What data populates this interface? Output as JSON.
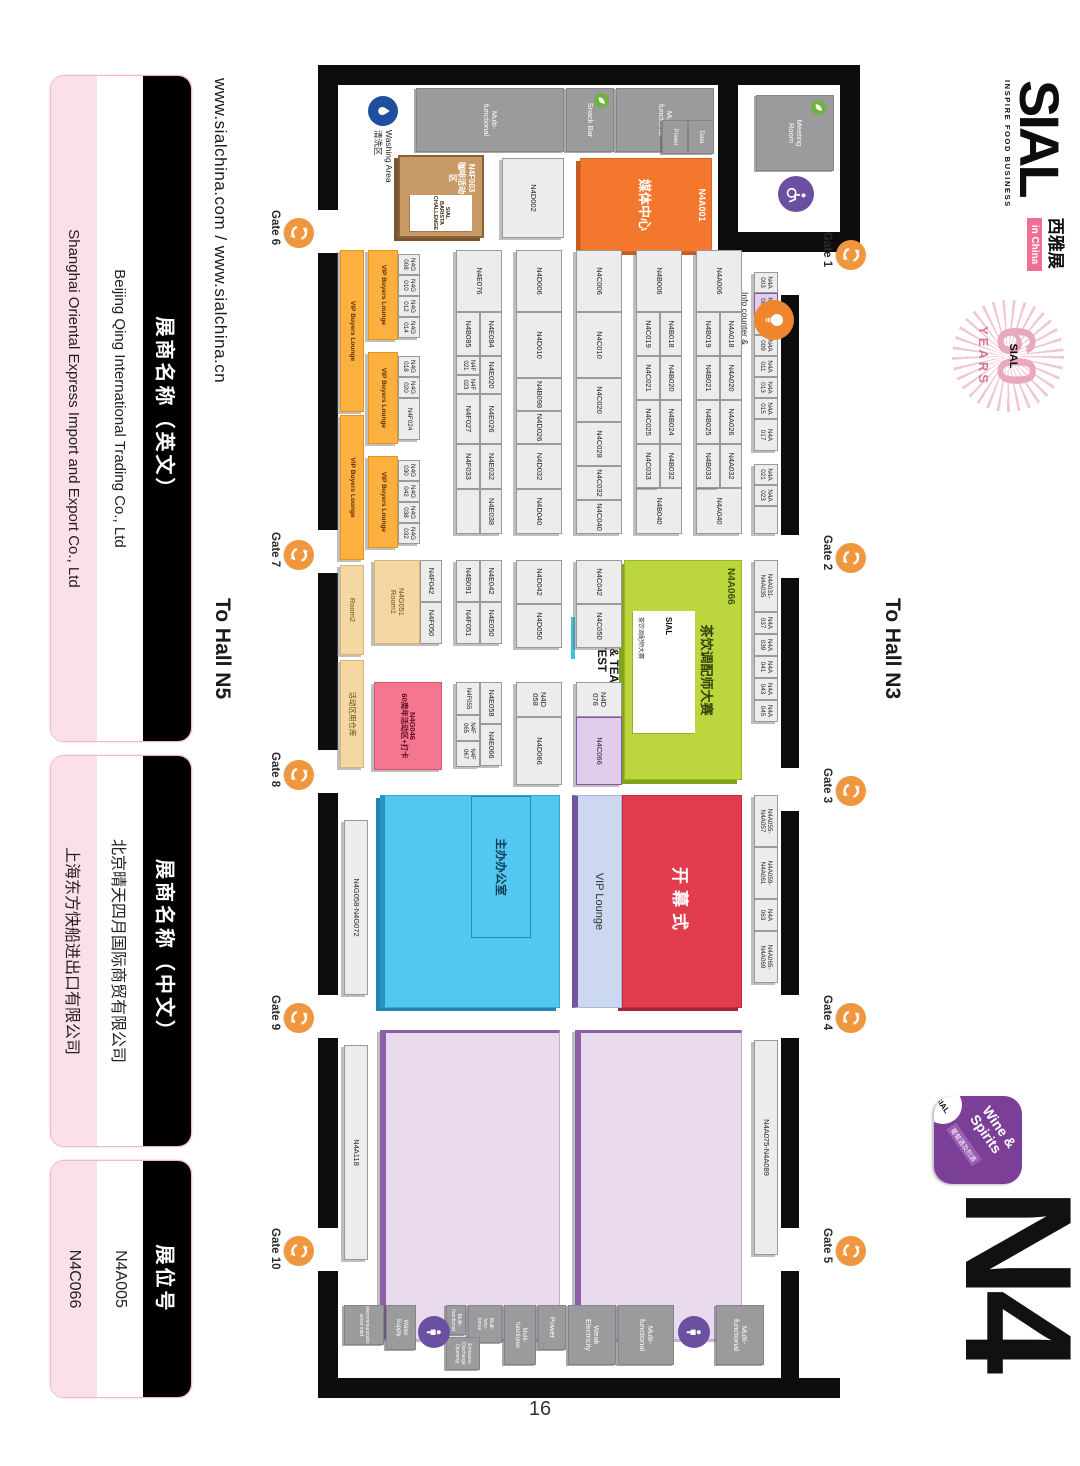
{
  "page": {
    "number": "16"
  },
  "branding": {
    "sial": "SIAL",
    "tagline": "INSPIRE FOOD BUSINESS",
    "cn_name": "西雅展",
    "in_china": "in China",
    "years_60": "60",
    "years_label": "YEARS",
    "years_sial": "SIAL",
    "hall_code": "N4",
    "wine_line": "Wine &\nSpirits",
    "wine_cn": "葡萄酒及烈酒",
    "wine_sial": "SIAL"
  },
  "links": {
    "urls": "www.sialchina.com / www.sialchina.cn"
  },
  "nav": {
    "to_n3": "To Hall N3",
    "to_n5": "To Hall N5"
  },
  "legend_cards": [
    {
      "header": "展商名称（英文）",
      "row1": "Beijing Qing International Trading Co., Ltd",
      "row2": "Shanghai Oriental Express Import and Export Co., Ltd"
    },
    {
      "header": "展商名称（中文）",
      "row1": "北京晴天四月国际商贸有限公司",
      "row2": "上海东方快船进出口有限公司"
    },
    {
      "header": "展位号",
      "row1": "N4A005",
      "row2": "N4C066"
    }
  ],
  "map": {
    "meeting_room": "Meeting\nRoom",
    "info_counter": "Info counter &\ncatalogue selling\n问讯处 & 会刊销售处",
    "washing": "Washing Area\n清洗区",
    "media_id": "N4A001",
    "media_label": "媒体中心",
    "coffee_id": "N4F003",
    "coffee_label": "咖啡活动区",
    "coffee_chip": "SIAL\nBARISTA\nCHALLENGE",
    "contest_id": "N4A066",
    "contest_label": "茶饮调配师大赛",
    "contest_chip_brand": "SIAL",
    "contest_chip_sub": "茶饮调配师大赛",
    "contest_chip_main": "CHIC & TEA\nCONTEST",
    "opening": "开幕式",
    "vip_lounge": "VIP Lounge",
    "office": "主办办公室"
  },
  "gates": [
    {
      "label": "Gate 1",
      "x": 240,
      "y": 214,
      "side": "top"
    },
    {
      "label": "Gate 2",
      "x": 543,
      "y": 214,
      "side": "top"
    },
    {
      "label": "Gate 3",
      "x": 776,
      "y": 214,
      "side": "top"
    },
    {
      "label": "Gate 4",
      "x": 1003,
      "y": 214,
      "side": "top"
    },
    {
      "label": "Gate 5",
      "x": 1236,
      "y": 214,
      "side": "top"
    },
    {
      "label": "Gate 6",
      "x": 218,
      "y": 766,
      "side": "bottom"
    },
    {
      "label": "Gate 7",
      "x": 540,
      "y": 766,
      "side": "bottom"
    },
    {
      "label": "Gate 8",
      "x": 760,
      "y": 766,
      "side": "bottom"
    },
    {
      "label": "Gate 9",
      "x": 1003,
      "y": 766,
      "side": "bottom"
    },
    {
      "label": "Gate 10",
      "x": 1236,
      "y": 766,
      "side": "bottom"
    }
  ],
  "icons": [
    {
      "glyph": "wheelchair",
      "name": "wheelchair-icon",
      "x": 176,
      "y": 266,
      "d": 36,
      "bg": "#6b4fa1"
    },
    {
      "glyph": "drop",
      "name": "washing-area-icon",
      "x": 96,
      "y": 682,
      "d": 30,
      "bg": "#1d4f9e"
    },
    {
      "glyph": "bulb",
      "name": "info-counter-icon",
      "x": 300,
      "y": 286,
      "d": 40,
      "bg": "#f0862c"
    },
    {
      "glyph": "leaf",
      "name": "meeting-room-eco-icon",
      "x": 100,
      "y": 254,
      "d": 15,
      "bg": "#6db33f"
    },
    {
      "glyph": "leaf",
      "name": "snack-bar-eco-icon",
      "x": 93,
      "y": 471,
      "d": 15,
      "bg": "#6db33f"
    },
    {
      "glyph": "person",
      "name": "restroom-icon-1",
      "x": 1316,
      "y": 370,
      "d": 32,
      "bg": "#6b4fa1"
    },
    {
      "glyph": "person",
      "name": "restroom-icon-2",
      "x": 1316,
      "y": 630,
      "d": 32,
      "bg": "#6b4fa1"
    }
  ],
  "booths": [
    {
      "t": "N4A\n003",
      "x": 272,
      "y": 302,
      "w": 21,
      "h": 24,
      "c": "b s2"
    },
    {
      "t": "N4A\n005",
      "x": 293,
      "y": 302,
      "w": 21,
      "h": 24,
      "c": "bp s2"
    },
    {
      "t": "N4A\n007",
      "x": 314,
      "y": 302,
      "w": 21,
      "h": 24,
      "c": "b s2"
    },
    {
      "t": "N4A\n009",
      "x": 335,
      "y": 302,
      "w": 21,
      "h": 24,
      "c": "b s2"
    },
    {
      "t": "N4A\n011",
      "x": 356,
      "y": 302,
      "w": 21,
      "h": 24,
      "c": "b s2"
    },
    {
      "t": "N4A\n013",
      "x": 377,
      "y": 302,
      "w": 21,
      "h": 24,
      "c": "b s2"
    },
    {
      "t": "N4A\n015",
      "x": 398,
      "y": 302,
      "w": 21,
      "h": 24,
      "c": "b s2"
    },
    {
      "t": "N4A\n017",
      "x": 419,
      "y": 302,
      "w": 32,
      "h": 24,
      "c": "b s2"
    },
    {
      "t": "N4A\n021",
      "x": 464,
      "y": 302,
      "w": 21,
      "h": 24,
      "c": "b s2"
    },
    {
      "t": "N4A\n023",
      "x": 485,
      "y": 302,
      "w": 21,
      "h": 24,
      "c": "b s2"
    },
    {
      "t": "",
      "x": 506,
      "y": 302,
      "w": 28,
      "h": 24,
      "c": "b s2"
    },
    {
      "t": "N4A006",
      "x": 250,
      "y": 338,
      "w": 62,
      "h": 46,
      "c": "b"
    },
    {
      "t": "N4A018",
      "x": 312,
      "y": 338,
      "w": 44,
      "h": 22,
      "c": "b"
    },
    {
      "t": "N4A020",
      "x": 356,
      "y": 338,
      "w": 44,
      "h": 22,
      "c": "b"
    },
    {
      "t": "N4A026",
      "x": 400,
      "y": 338,
      "w": 44,
      "h": 22,
      "c": "b"
    },
    {
      "t": "N4A032",
      "x": 444,
      "y": 338,
      "w": 44,
      "h": 22,
      "c": "b"
    },
    {
      "t": "N4A040",
      "x": 488,
      "y": 338,
      "w": 46,
      "h": 46,
      "c": "b"
    },
    {
      "t": "N4B019",
      "x": 312,
      "y": 360,
      "w": 44,
      "h": 24,
      "c": "b"
    },
    {
      "t": "N4B021",
      "x": 356,
      "y": 360,
      "w": 44,
      "h": 24,
      "c": "b"
    },
    {
      "t": "N4B025",
      "x": 400,
      "y": 360,
      "w": 44,
      "h": 24,
      "c": "b"
    },
    {
      "t": "N4B033",
      "x": 444,
      "y": 360,
      "w": 44,
      "h": 24,
      "c": "b"
    },
    {
      "t": "N4B006",
      "x": 250,
      "y": 398,
      "w": 62,
      "h": 46,
      "c": "b"
    },
    {
      "t": "N4B018",
      "x": 312,
      "y": 398,
      "w": 44,
      "h": 22,
      "c": "b"
    },
    {
      "t": "N4B020",
      "x": 356,
      "y": 398,
      "w": 44,
      "h": 22,
      "c": "b"
    },
    {
      "t": "N4B024",
      "x": 400,
      "y": 398,
      "w": 44,
      "h": 22,
      "c": "b"
    },
    {
      "t": "N4B032",
      "x": 444,
      "y": 398,
      "w": 44,
      "h": 22,
      "c": "b"
    },
    {
      "t": "N4B040",
      "x": 488,
      "y": 398,
      "w": 46,
      "h": 46,
      "c": "b"
    },
    {
      "t": "N4C019",
      "x": 312,
      "y": 420,
      "w": 44,
      "h": 24,
      "c": "b"
    },
    {
      "t": "N4C021",
      "x": 356,
      "y": 420,
      "w": 44,
      "h": 24,
      "c": "b"
    },
    {
      "t": "N4C025",
      "x": 400,
      "y": 420,
      "w": 44,
      "h": 24,
      "c": "b"
    },
    {
      "t": "N4C033",
      "x": 444,
      "y": 420,
      "w": 44,
      "h": 24,
      "c": "b"
    },
    {
      "t": "N4C006",
      "x": 250,
      "y": 458,
      "w": 62,
      "h": 46,
      "c": "b"
    },
    {
      "t": "N4C010",
      "x": 312,
      "y": 458,
      "w": 66,
      "h": 46,
      "c": "b"
    },
    {
      "t": "N4C020",
      "x": 378,
      "y": 458,
      "w": 44,
      "h": 46,
      "c": "b"
    },
    {
      "t": "N4C028",
      "x": 422,
      "y": 458,
      "w": 44,
      "h": 46,
      "c": "b"
    },
    {
      "t": "N4C032",
      "x": 466,
      "y": 458,
      "w": 34,
      "h": 46,
      "c": "b"
    },
    {
      "t": "N4C040",
      "x": 500,
      "y": 458,
      "w": 34,
      "h": 46,
      "c": "b"
    },
    {
      "t": "N4D006",
      "x": 250,
      "y": 518,
      "w": 62,
      "h": 46,
      "c": "b"
    },
    {
      "t": "N4D010",
      "x": 312,
      "y": 518,
      "w": 66,
      "h": 46,
      "c": "b"
    },
    {
      "t": "N4B098",
      "x": 378,
      "y": 518,
      "w": 33,
      "h": 46,
      "c": "b"
    },
    {
      "t": "N4D026",
      "x": 411,
      "y": 518,
      "w": 33,
      "h": 46,
      "c": "b"
    },
    {
      "t": "N4D032",
      "x": 444,
      "y": 518,
      "w": 45,
      "h": 46,
      "c": "b"
    },
    {
      "t": "N4D040",
      "x": 489,
      "y": 518,
      "w": 45,
      "h": 46,
      "c": "b"
    },
    {
      "t": "N4E076",
      "x": 250,
      "y": 578,
      "w": 62,
      "h": 46,
      "c": "b"
    },
    {
      "t": "N4E084",
      "x": 312,
      "y": 578,
      "w": 44,
      "h": 22,
      "c": "b"
    },
    {
      "t": "N4E020",
      "x": 356,
      "y": 578,
      "w": 38,
      "h": 22,
      "c": "b"
    },
    {
      "t": "N4E026",
      "x": 394,
      "y": 578,
      "w": 50,
      "h": 22,
      "c": "b"
    },
    {
      "t": "N4E032",
      "x": 444,
      "y": 578,
      "w": 45,
      "h": 22,
      "c": "b"
    },
    {
      "t": "N4E038",
      "x": 489,
      "y": 578,
      "w": 45,
      "h": 22,
      "c": "b"
    },
    {
      "t": "N4B085",
      "x": 312,
      "y": 600,
      "w": 44,
      "h": 24,
      "c": "b"
    },
    {
      "t": "N4F\n021",
      "x": 356,
      "y": 600,
      "w": 19,
      "h": 24,
      "c": "b tiny"
    },
    {
      "t": "N4F\n023",
      "x": 375,
      "y": 600,
      "w": 19,
      "h": 24,
      "c": "b tiny"
    },
    {
      "t": "N4F027",
      "x": 394,
      "y": 600,
      "w": 50,
      "h": 24,
      "c": "b"
    },
    {
      "t": "N4F033",
      "x": 444,
      "y": 600,
      "w": 45,
      "h": 24,
      "c": "b"
    },
    {
      "t": "",
      "x": 489,
      "y": 600,
      "w": 45,
      "h": 24,
      "c": "b"
    },
    {
      "t": "N4G\n008",
      "x": 254,
      "y": 660,
      "w": 21,
      "h": 22,
      "c": "b s2"
    },
    {
      "t": "N4G\n010",
      "x": 275,
      "y": 660,
      "w": 21,
      "h": 22,
      "c": "b s2"
    },
    {
      "t": "N4G\n012",
      "x": 296,
      "y": 660,
      "w": 21,
      "h": 22,
      "c": "b s2"
    },
    {
      "t": "N4G\n014",
      "x": 317,
      "y": 660,
      "w": 21,
      "h": 22,
      "c": "b s2"
    },
    {
      "t": "N4G\n018",
      "x": 356,
      "y": 660,
      "w": 21,
      "h": 22,
      "c": "b s2"
    },
    {
      "t": "N4G\n020",
      "x": 377,
      "y": 660,
      "w": 21,
      "h": 22,
      "c": "b s2"
    },
    {
      "t": "N4F024",
      "x": 398,
      "y": 660,
      "w": 42,
      "h": 22,
      "c": "b s2"
    },
    {
      "t": "N4G\n030",
      "x": 460,
      "y": 660,
      "w": 21,
      "h": 22,
      "c": "b s2"
    },
    {
      "t": "N4G\n042",
      "x": 481,
      "y": 660,
      "w": 21,
      "h": 22,
      "c": "b s2"
    },
    {
      "t": "N4G\n038",
      "x": 502,
      "y": 660,
      "w": 21,
      "h": 22,
      "c": "b s2"
    },
    {
      "t": "N4G\n032",
      "x": 523,
      "y": 660,
      "w": 21,
      "h": 22,
      "c": "b s2"
    },
    {
      "t": "VIP Buyers Lounge",
      "x": 250,
      "y": 682,
      "w": 90,
      "h": 30,
      "c": "vip"
    },
    {
      "t": "VIP Buyers Lounge",
      "x": 352,
      "y": 682,
      "w": 92,
      "h": 30,
      "c": "vip"
    },
    {
      "t": "VIP Buyers Lounge",
      "x": 456,
      "y": 682,
      "w": 92,
      "h": 30,
      "c": "vip"
    },
    {
      "t": "VIP Buyers Lounge",
      "x": 250,
      "y": 716,
      "w": 162,
      "h": 24,
      "c": "vip"
    },
    {
      "t": "VIP Buyers Lounge",
      "x": 415,
      "y": 716,
      "w": 145,
      "h": 24,
      "c": "vip"
    },
    {
      "t": "N4A031-\nN4A035",
      "x": 560,
      "y": 302,
      "w": 52,
      "h": 24,
      "c": "b s2"
    },
    {
      "t": "N4A\n037",
      "x": 612,
      "y": 302,
      "w": 22,
      "h": 24,
      "c": "b s2"
    },
    {
      "t": "N4A\n039",
      "x": 634,
      "y": 302,
      "w": 22,
      "h": 24,
      "c": "b s2"
    },
    {
      "t": "N4A\n041",
      "x": 656,
      "y": 302,
      "w": 22,
      "h": 24,
      "c": "b s2"
    },
    {
      "t": "N4A\n043",
      "x": 678,
      "y": 302,
      "w": 22,
      "h": 24,
      "c": "b s2"
    },
    {
      "t": "N4A\n045",
      "x": 700,
      "y": 302,
      "w": 22,
      "h": 24,
      "c": "b s2"
    },
    {
      "t": "N4C042",
      "x": 560,
      "y": 458,
      "w": 44,
      "h": 46,
      "c": "b"
    },
    {
      "t": "N4C050",
      "x": 604,
      "y": 458,
      "w": 44,
      "h": 46,
      "c": "b"
    },
    {
      "t": "N4D\n076",
      "x": 682,
      "y": 458,
      "w": 35,
      "h": 46,
      "c": "b"
    },
    {
      "t": "N4C066",
      "x": 717,
      "y": 458,
      "w": 68,
      "h": 46,
      "c": "bp"
    },
    {
      "t": "N4D042",
      "x": 560,
      "y": 518,
      "w": 44,
      "h": 46,
      "c": "b"
    },
    {
      "t": "N4D050",
      "x": 604,
      "y": 518,
      "w": 44,
      "h": 46,
      "c": "b"
    },
    {
      "t": "N4D\n058",
      "x": 682,
      "y": 518,
      "w": 35,
      "h": 46,
      "c": "b"
    },
    {
      "t": "N4D066",
      "x": 717,
      "y": 518,
      "w": 68,
      "h": 46,
      "c": "b"
    },
    {
      "t": "N4E042",
      "x": 560,
      "y": 578,
      "w": 42,
      "h": 22,
      "c": "b"
    },
    {
      "t": "N4E050",
      "x": 602,
      "y": 578,
      "w": 42,
      "h": 22,
      "c": "b"
    },
    {
      "t": "N4E058",
      "x": 682,
      "y": 578,
      "w": 42,
      "h": 22,
      "c": "b"
    },
    {
      "t": "N4E066",
      "x": 724,
      "y": 578,
      "w": 42,
      "h": 22,
      "c": "b"
    },
    {
      "t": "N4B091",
      "x": 560,
      "y": 600,
      "w": 42,
      "h": 24,
      "c": "b"
    },
    {
      "t": "N4F051",
      "x": 602,
      "y": 600,
      "w": 42,
      "h": 24,
      "c": "b"
    },
    {
      "t": "N4F055",
      "x": 682,
      "y": 600,
      "w": 33,
      "h": 24,
      "c": "b tiny"
    },
    {
      "t": "N4F\n065",
      "x": 715,
      "y": 600,
      "w": 26,
      "h": 24,
      "c": "b tiny"
    },
    {
      "t": "N4F\n067",
      "x": 741,
      "y": 600,
      "w": 26,
      "h": 24,
      "c": "b tiny"
    },
    {
      "t": "N4F042",
      "x": 560,
      "y": 638,
      "w": 42,
      "h": 22,
      "c": "b"
    },
    {
      "t": "N4F050",
      "x": 602,
      "y": 638,
      "w": 42,
      "h": 22,
      "c": "b"
    },
    {
      "t": "N4G051\nRoom1",
      "x": 560,
      "y": 660,
      "w": 84,
      "h": 46,
      "c": "tan"
    },
    {
      "t": "N4G046\n60周年活动区+打卡",
      "x": 682,
      "y": 638,
      "w": 88,
      "h": 68,
      "c": "pink"
    },
    {
      "t": "Room2",
      "x": 565,
      "y": 716,
      "w": 90,
      "h": 24,
      "c": "tan"
    },
    {
      "t": "活动区用仓库",
      "x": 660,
      "y": 716,
      "w": 108,
      "h": 24,
      "c": "tan"
    },
    {
      "t": "N4A055-\nN4A057",
      "x": 795,
      "y": 302,
      "w": 52,
      "h": 24,
      "c": "b s2"
    },
    {
      "t": "N4A059-\nN4A061",
      "x": 847,
      "y": 302,
      "w": 52,
      "h": 24,
      "c": "b s2"
    },
    {
      "t": "N4A\n063",
      "x": 899,
      "y": 302,
      "w": 32,
      "h": 24,
      "c": "b s2"
    },
    {
      "t": "N4A065-\nN4A069",
      "x": 931,
      "y": 302,
      "w": 52,
      "h": 24,
      "c": "b s2"
    },
    {
      "t": "N4G058-N4G072",
      "x": 820,
      "y": 712,
      "w": 175,
      "h": 24,
      "c": "b"
    },
    {
      "t": "N4A075-N4A089",
      "x": 1040,
      "y": 302,
      "w": 215,
      "h": 24,
      "c": "b"
    },
    {
      "t": "",
      "x": 1030,
      "y": 338,
      "w": 310,
      "h": 167,
      "c": "lav"
    },
    {
      "t": "",
      "x": 1030,
      "y": 520,
      "w": 310,
      "h": 180,
      "c": "lav"
    },
    {
      "t": "N4A118",
      "x": 1045,
      "y": 712,
      "w": 215,
      "h": 24,
      "c": "b"
    },
    {
      "t": "N4D002",
      "x": 158,
      "y": 516,
      "w": 80,
      "h": 62,
      "c": "b"
    },
    {
      "t": "Meeting\nRoom",
      "x": 95,
      "y": 246,
      "w": 76,
      "h": 78,
      "c": "fac"
    },
    {
      "t": "Multi-\nfunctional",
      "x": 88,
      "y": 366,
      "w": 64,
      "h": 98,
      "c": "fac"
    },
    {
      "t": "Data",
      "x": 120,
      "y": 366,
      "w": 34,
      "h": 26,
      "c": "fac tiny"
    },
    {
      "t": "Power",
      "x": 120,
      "y": 392,
      "w": 34,
      "h": 26,
      "c": "fac tiny"
    },
    {
      "t": "Snack Bar",
      "x": 88,
      "y": 466,
      "w": 64,
      "h": 48,
      "c": "fac"
    },
    {
      "t": "Multi-\nfunctional",
      "x": 88,
      "y": 516,
      "w": 64,
      "h": 148,
      "c": "fac"
    },
    {
      "t": "Multi-\nfunctional",
      "x": 1305,
      "y": 316,
      "w": 60,
      "h": 48,
      "c": "fac"
    },
    {
      "t": "Multi-\nfunctional",
      "x": 1305,
      "y": 406,
      "w": 60,
      "h": 56,
      "c": "fac"
    },
    {
      "t": "Weak\nElectricity",
      "x": 1305,
      "y": 464,
      "w": 60,
      "h": 48,
      "c": "fac"
    },
    {
      "t": "Power",
      "x": 1305,
      "y": 514,
      "w": 45,
      "h": 28,
      "c": "fac"
    },
    {
      "t": "Multi-\nfunctional",
      "x": 1305,
      "y": 544,
      "w": 60,
      "h": 32,
      "c": "fac tiny"
    },
    {
      "t": "Multi-\nfunc-\ntional",
      "x": 1305,
      "y": 578,
      "w": 38,
      "h": 34,
      "c": "fac t1"
    },
    {
      "t": "Multi-\nfunctional",
      "x": 1305,
      "y": 614,
      "w": 30,
      "h": 20,
      "c": "fac t1"
    },
    {
      "t": "Emission\nDischarge\nOpening",
      "x": 1337,
      "y": 600,
      "w": 33,
      "h": 34,
      "c": "fac t1"
    },
    {
      "t": "Water\nSupply",
      "x": 1305,
      "y": 664,
      "w": 45,
      "h": 30,
      "c": "fac tiny"
    },
    {
      "t": "Telecommunication\nwires inlet",
      "x": 1305,
      "y": 696,
      "w": 40,
      "h": 40,
      "c": "fac t1"
    }
  ]
}
